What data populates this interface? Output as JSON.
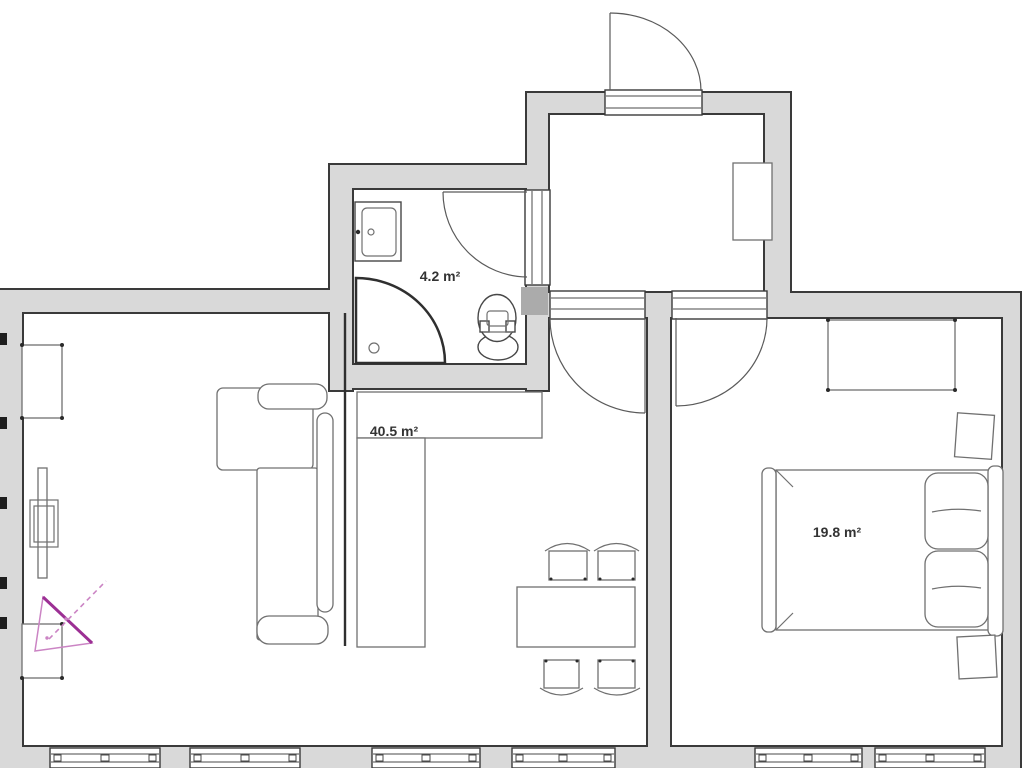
{
  "document_kind": "apartment floor plan",
  "rooms": {
    "bathroom": {
      "name": "bathroom",
      "area_label": "4.2 m²"
    },
    "living_kitchen": {
      "name": "living room with kitchen",
      "area_label": "40.5 m²"
    },
    "bedroom": {
      "name": "bedroom",
      "area_label": "19.8 m²"
    },
    "hall": {
      "name": "entrance hall",
      "area_label": ""
    }
  },
  "inventory": {
    "bathroom": [
      "sink",
      "corner-shower",
      "toilet",
      "door-to-hall"
    ],
    "hall": [
      "entrance-door",
      "wardrobe",
      "door-to-living-room",
      "door-to-bedroom"
    ],
    "living_kitchen": [
      "kitchen-counter-l-shape",
      "kitchen-partition",
      "corner-sofa",
      "tv",
      "tv-mount",
      "wall-shelf-top",
      "wall-shelf-bottom",
      "dining-table",
      "chair",
      "chair",
      "chair",
      "chair",
      "camera-view-marker"
    ],
    "bedroom": [
      "wardrobe",
      "double-bed",
      "pillow",
      "pillow",
      "nightstand",
      "nightstand"
    ]
  },
  "window_count": 6,
  "colors": {
    "wall-fill": "#d9d9d9",
    "wall-edge": "#3a3a3a",
    "wall-junction": "#ababab",
    "furniture-line": "#707070",
    "fixture-line": "#474747",
    "label-text": "#333333",
    "marker-strong": "#9c2f94",
    "marker-light": "#cb84c4",
    "background": "#ffffff"
  }
}
